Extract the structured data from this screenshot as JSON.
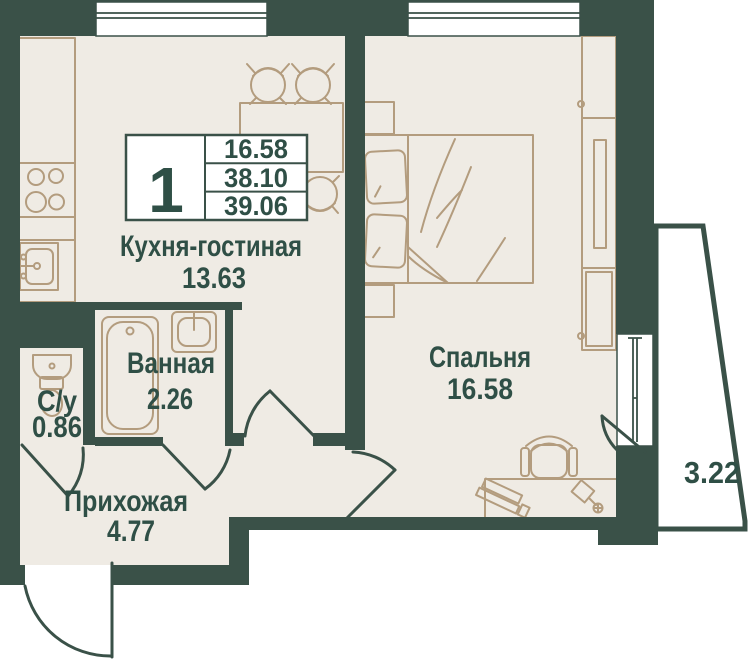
{
  "palette": {
    "wall": "#3A5148",
    "floor": "#EFEBE4",
    "furniture": "#B39C7E",
    "label": "#2F4F46",
    "background": "#FFFFFF"
  },
  "legend": {
    "unit_number": "1",
    "areas": [
      "16.58",
      "38.10",
      "39.06"
    ]
  },
  "rooms": {
    "kitchen": {
      "name": "Кухня-гостиная",
      "area": "13.63"
    },
    "bedroom": {
      "name": "Спальня",
      "area": "16.58"
    },
    "bathroom": {
      "name": "Ванная",
      "area": "2.26"
    },
    "wc": {
      "name": "С/у",
      "area": "0.86"
    },
    "hallway": {
      "name": "Прихожая",
      "area": "4.77"
    },
    "balcony": {
      "area": "3.22"
    }
  }
}
